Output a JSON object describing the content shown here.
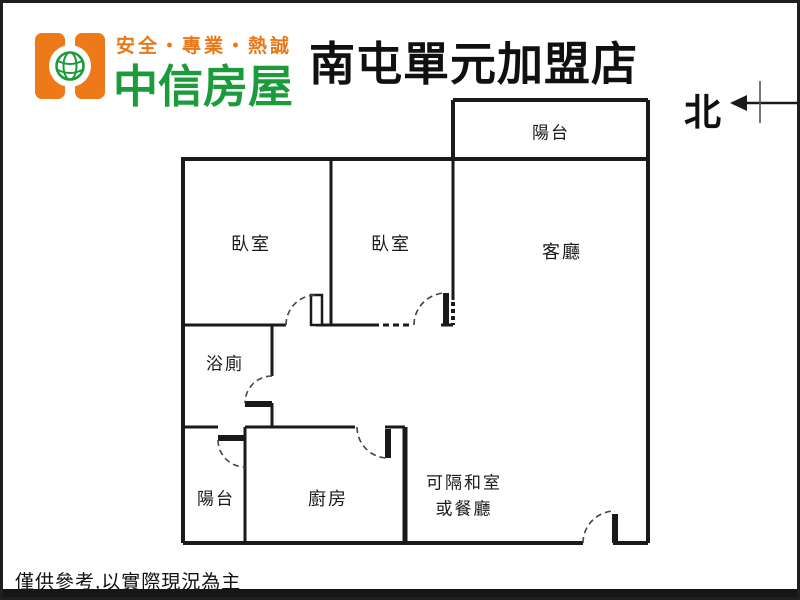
{
  "header": {
    "slogan": "安全・專業・熱誠",
    "brand": "中信房屋",
    "store_title": "南屯單元加盟店",
    "north_label": "北"
  },
  "floorplan": {
    "rooms": [
      {
        "id": "balcony-top",
        "label": "陽台"
      },
      {
        "id": "bedroom-1",
        "label": "臥室"
      },
      {
        "id": "bedroom-2",
        "label": "臥室"
      },
      {
        "id": "living-room",
        "label": "客廳"
      },
      {
        "id": "bathroom",
        "label": "浴廁"
      },
      {
        "id": "balcony-bottom",
        "label": "陽台"
      },
      {
        "id": "kitchen",
        "label": "廚房"
      },
      {
        "id": "flex-room",
        "label_line1": "可隔和室",
        "label_line2": "或餐廳"
      }
    ]
  },
  "footer": {
    "disclaimer": "僅供參考,以實際現況為主"
  },
  "colors": {
    "brand_orange": "#ee7918",
    "brand_green": "#1c9b3b",
    "wall_line": "#1a1a1a"
  }
}
